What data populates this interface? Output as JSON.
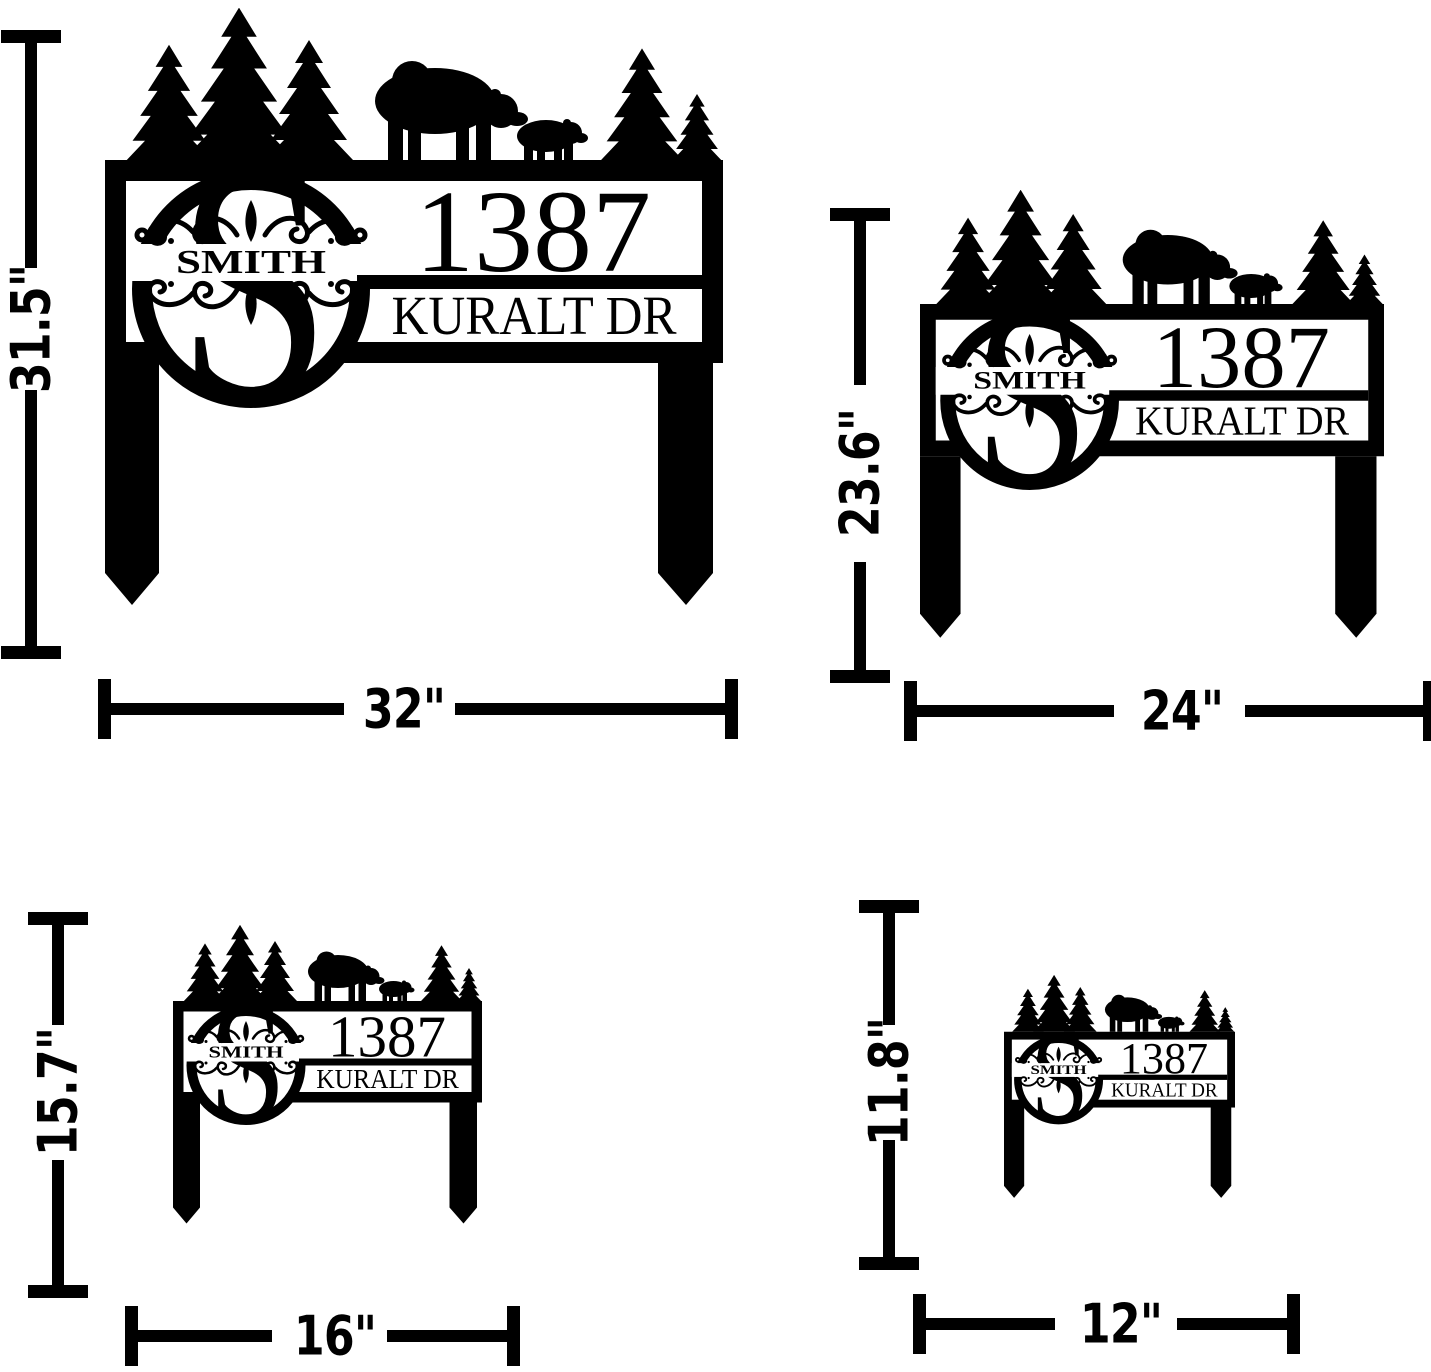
{
  "page": {
    "description": "Size chart for personalized monogram metal address yard sign with stakes, shown in four sizes",
    "background": "#ffffff",
    "ink_color": "#000000"
  },
  "sign": {
    "monogram_letter": "S",
    "family_name": "SMITH",
    "address_number": "1387",
    "street_name": "KURALT DR",
    "scene": [
      "pine-trees",
      "mama-bear",
      "bear-cub"
    ]
  },
  "variants": [
    {
      "id": "size-32",
      "width_label": "32\"",
      "height_label": "31.5\""
    },
    {
      "id": "size-24",
      "width_label": "24\"",
      "height_label": "23.6\""
    },
    {
      "id": "size-16",
      "width_label": "16\"",
      "height_label": "15.7\""
    },
    {
      "id": "size-12",
      "width_label": "12\"",
      "height_label": "11.8\""
    }
  ]
}
